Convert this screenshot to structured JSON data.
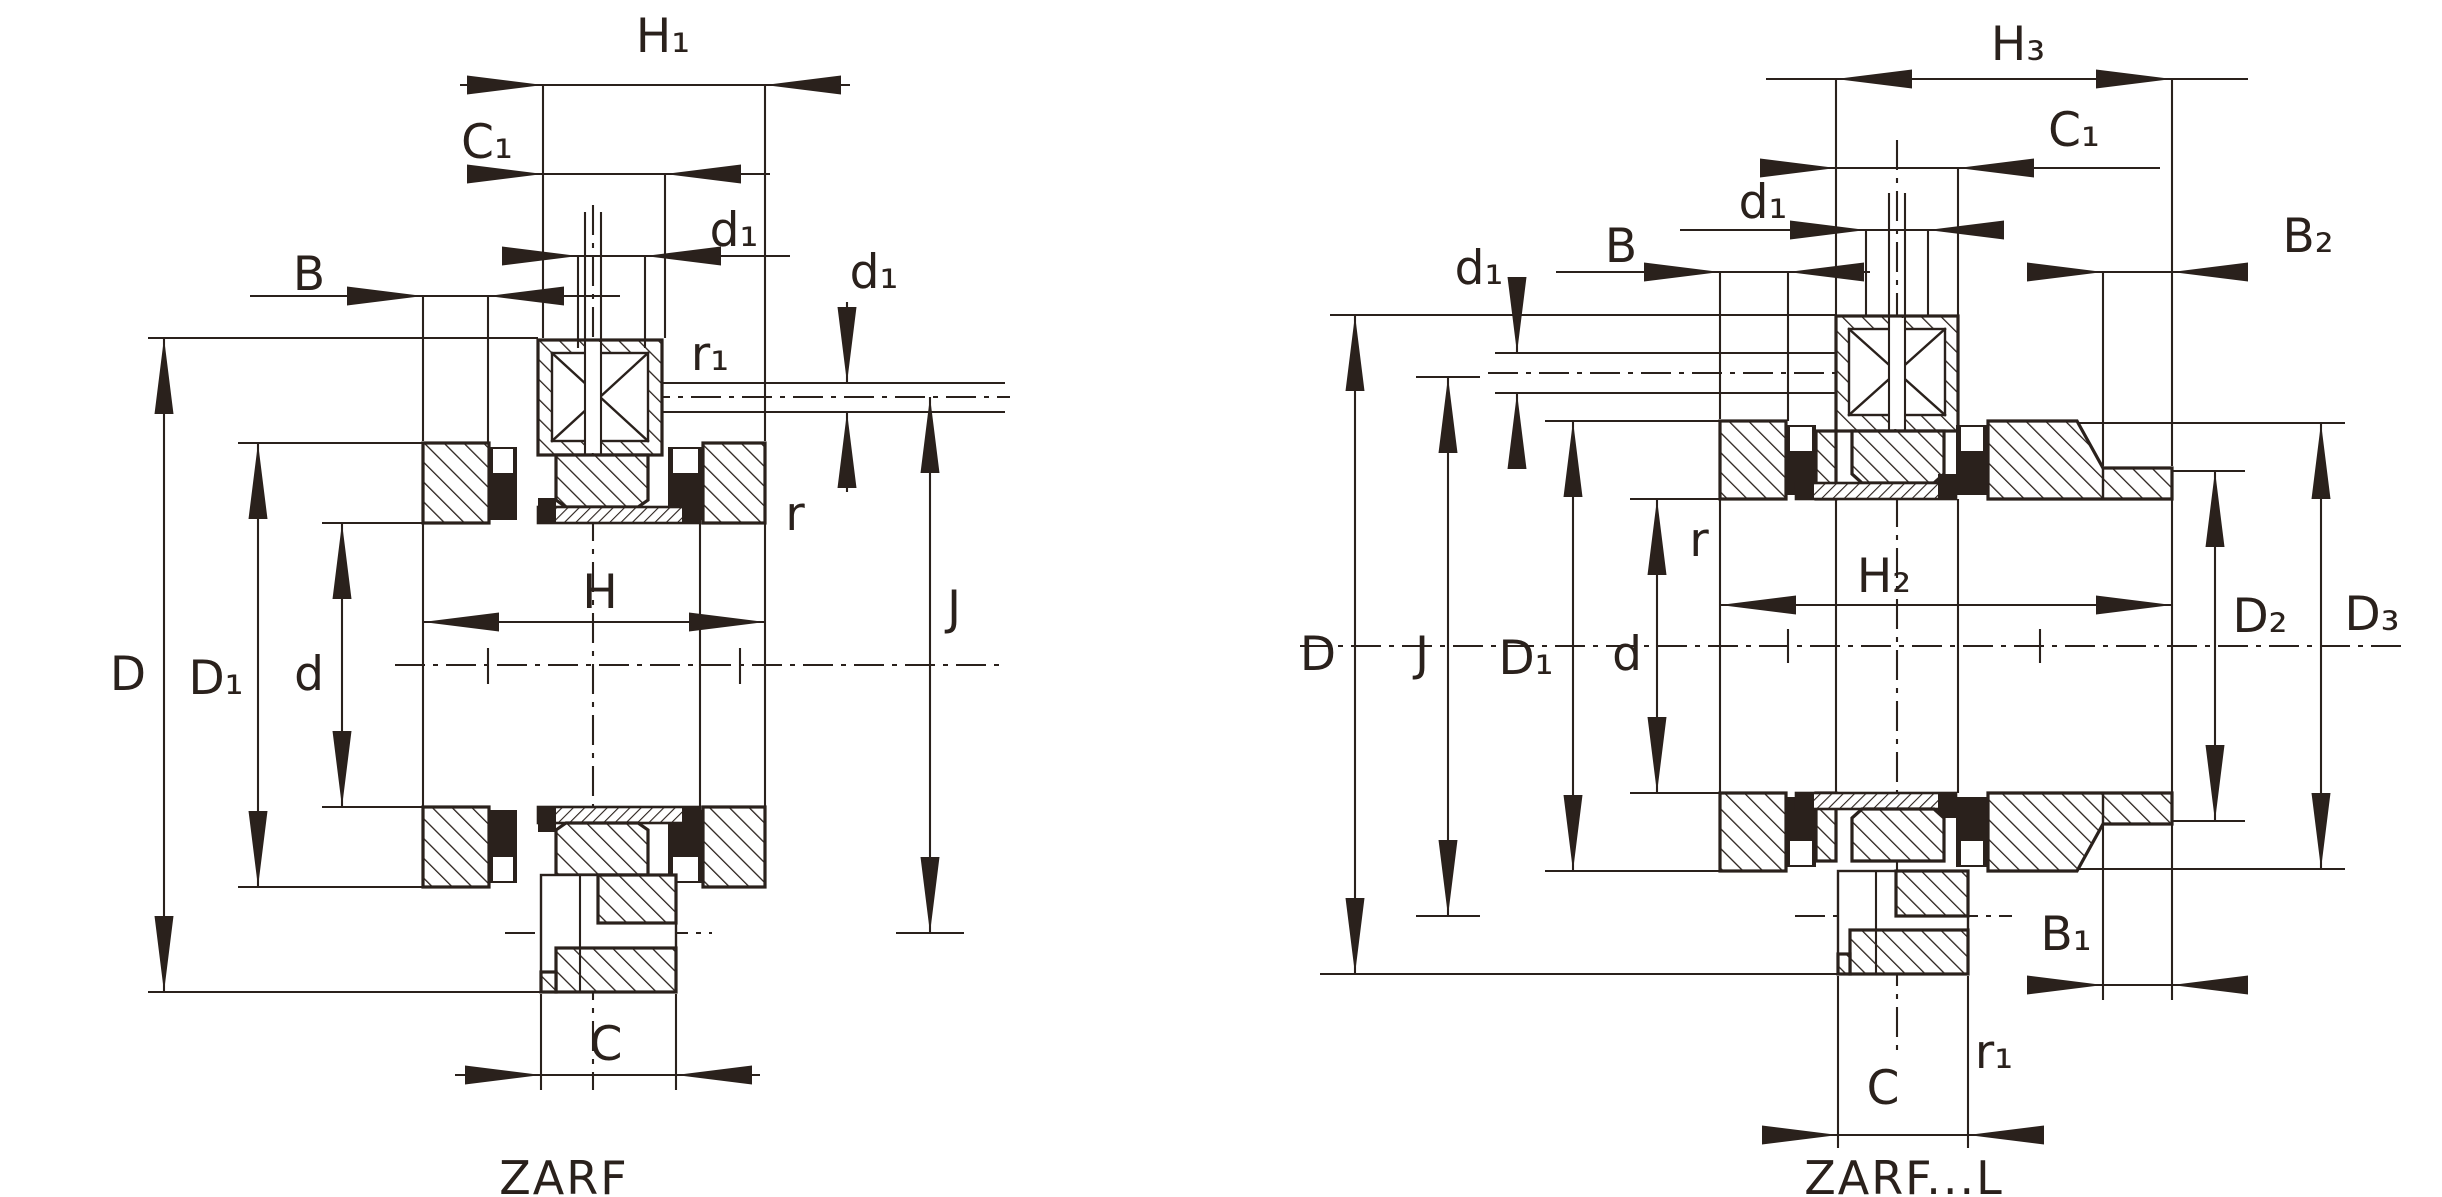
{
  "drawing": {
    "type": "bearing-cross-section-technical-drawing",
    "line_color": "#2a211c",
    "background_color": "#ffffff",
    "left_diagram": {
      "caption": "ZARF",
      "labels": {
        "H1": "H₁",
        "C1": "C₁",
        "d1_top": "d₁",
        "B": "B",
        "r1": "r₁",
        "d1_side": "d₁",
        "r": "r",
        "H": "H",
        "D": "D",
        "D1": "D₁",
        "d": "d",
        "J": "J",
        "C": "C"
      }
    },
    "right_diagram": {
      "caption": "ZARF...L",
      "labels": {
        "H3": "H₃",
        "C1": "C₁",
        "d1_top": "d₁",
        "B": "B",
        "d1_side": "d₁",
        "B2": "B₂",
        "r": "r",
        "H2": "H₂",
        "D": "D",
        "J": "J",
        "D1": "D₁",
        "d": "d",
        "D2": "D₂",
        "D3": "D₃",
        "B1": "B₁",
        "C": "C",
        "r1": "r₁"
      }
    }
  }
}
